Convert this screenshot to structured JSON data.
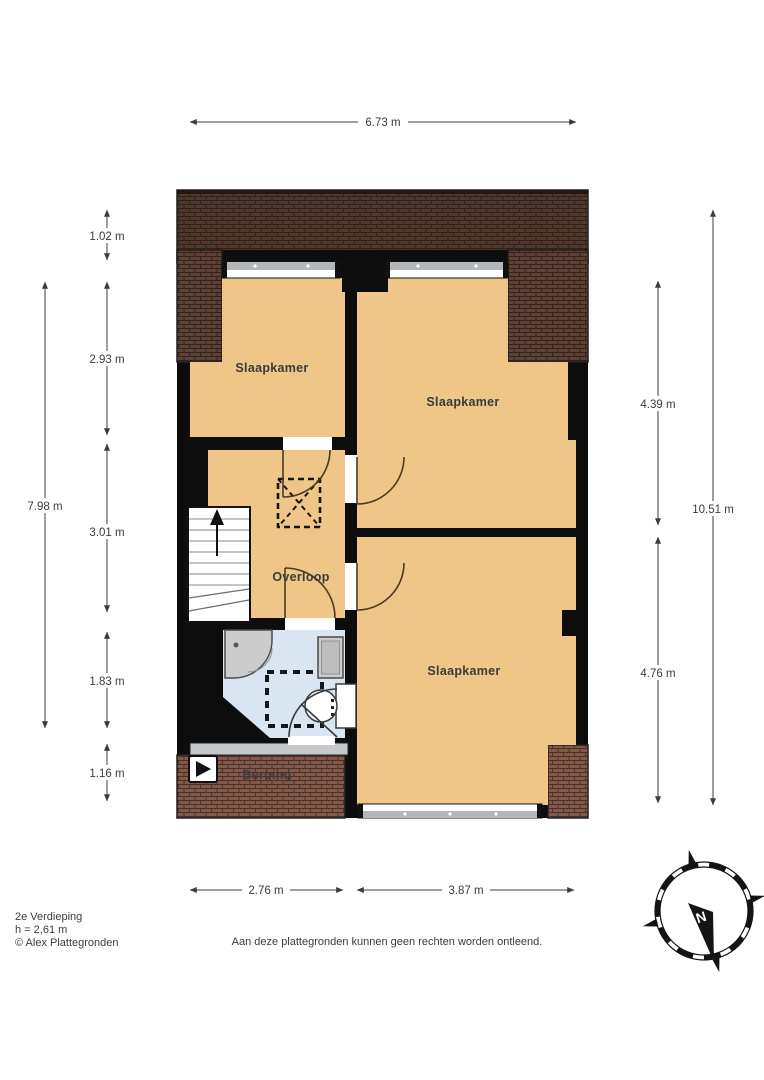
{
  "meta": {
    "floor_title": "2e Verdieping",
    "height_note": "h = 2,61 m",
    "credit": "© Alex Plattegronden",
    "disclaimer": "Aan deze plattegronden kunnen geen rechten worden ontleend."
  },
  "compass": {
    "north_label": "N"
  },
  "rooms": {
    "bedroom_top_left": "Slaapkamer",
    "bedroom_top_right": "Slaapkamer",
    "bedroom_bottom_right": "Slaapkamer",
    "landing": "Overloop",
    "storage": "Berging"
  },
  "dimensions": {
    "top_total": "6.73 m",
    "left_total": "7.98 m",
    "left_seg_1": "1.02 m",
    "left_seg_2": "2.93 m",
    "left_seg_3": "3.01 m",
    "left_seg_4": "1.83 m",
    "left_seg_5": "1.16 m",
    "right_seg_1": "4.39 m",
    "right_seg_2": "4.76 m",
    "right_total": "10.51 m",
    "bottom_seg_1": "2.76 m",
    "bottom_seg_2": "3.87 m"
  },
  "colors": {
    "room_fill": "#efc687",
    "bathroom_fill": "#d9e5f1",
    "wall": "#0d0d0d",
    "roof_dark": "#5c4134",
    "roof_red": "#80594a",
    "window_sill": "#b3b7b9",
    "dimension_ink": "#3c3c3c"
  }
}
